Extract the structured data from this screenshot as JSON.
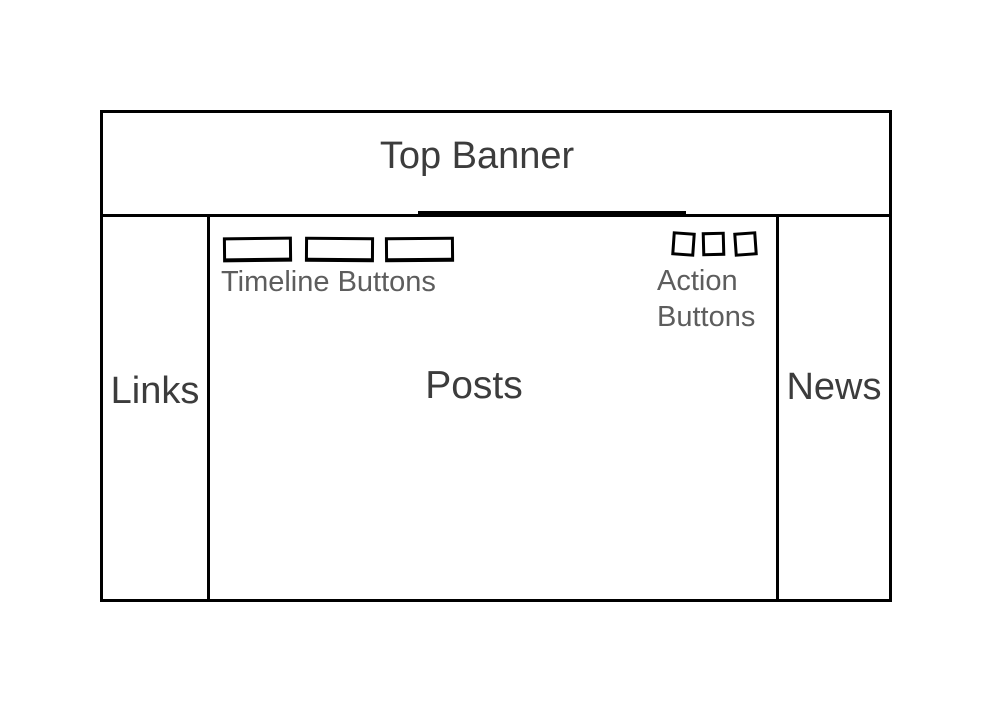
{
  "wireframe": {
    "banner": {
      "label": "Top Banner"
    },
    "left_sidebar": {
      "label": "Links"
    },
    "right_sidebar": {
      "label": "News"
    },
    "main": {
      "posts_label": "Posts",
      "timeline": {
        "label": "Timeline Buttons",
        "button_count": 3
      },
      "actions": {
        "label": "Action Buttons",
        "button_count": 3
      }
    },
    "colors": {
      "stroke": "#000000",
      "heading_text": "#3c3c3c",
      "caption_text": "#5d5d5d",
      "background": "#ffffff"
    }
  }
}
